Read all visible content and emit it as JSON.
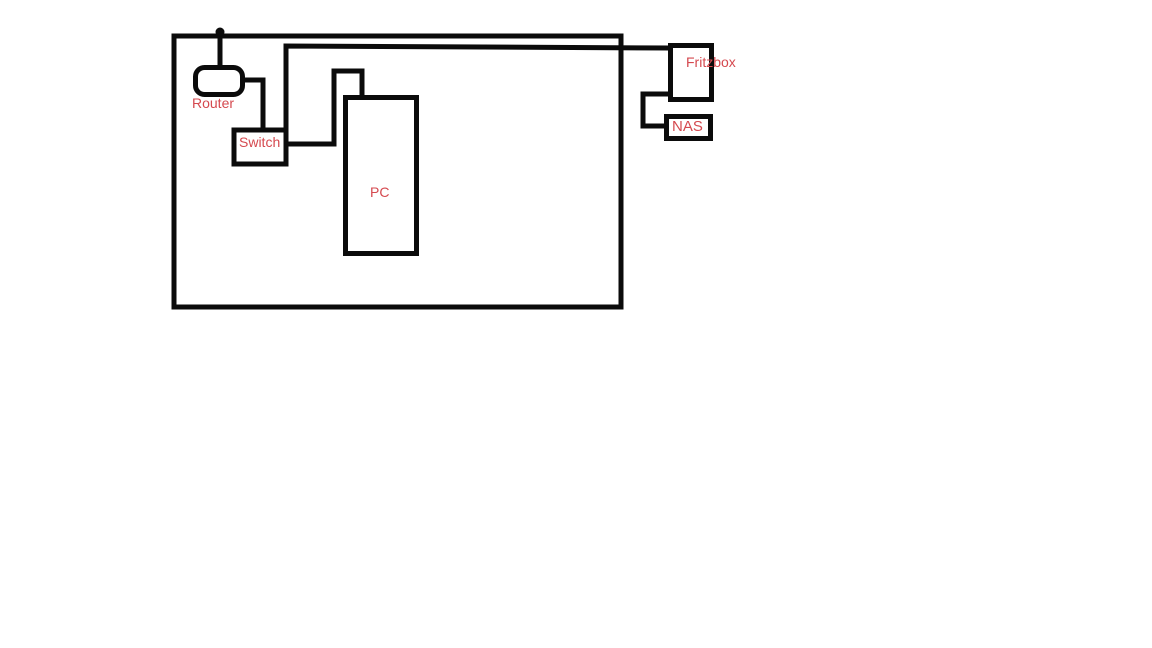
{
  "diagram": {
    "description": "Hand-drawn network topology sketch on white canvas",
    "background_color": "#ffffff",
    "line_color": "#0b0b0b",
    "label_color": "#d5494f",
    "nodes": {
      "router": {
        "label": "Router",
        "location": "inside room, top left, rounded box with antenna dot"
      },
      "switch": {
        "label": "Switch",
        "location": "inside room, below router"
      },
      "pc": {
        "label": "PC",
        "location": "inside room, tall box center-left"
      },
      "fritzbox": {
        "label": "Fritzbox",
        "location": "outside room, top right"
      },
      "nas": {
        "label": "NAS",
        "location": "outside room, below Fritzbox"
      }
    },
    "edges": [
      {
        "from": "router",
        "to": "switch"
      },
      {
        "from": "switch",
        "to": "pc"
      },
      {
        "from": "fritzbox",
        "to": "switch",
        "note": "long line crossing the room wall"
      },
      {
        "from": "fritzbox",
        "to": "nas"
      }
    ],
    "boundary": {
      "name": "room outline",
      "shape": "large rectangle enclosing Router, Switch and PC"
    }
  }
}
